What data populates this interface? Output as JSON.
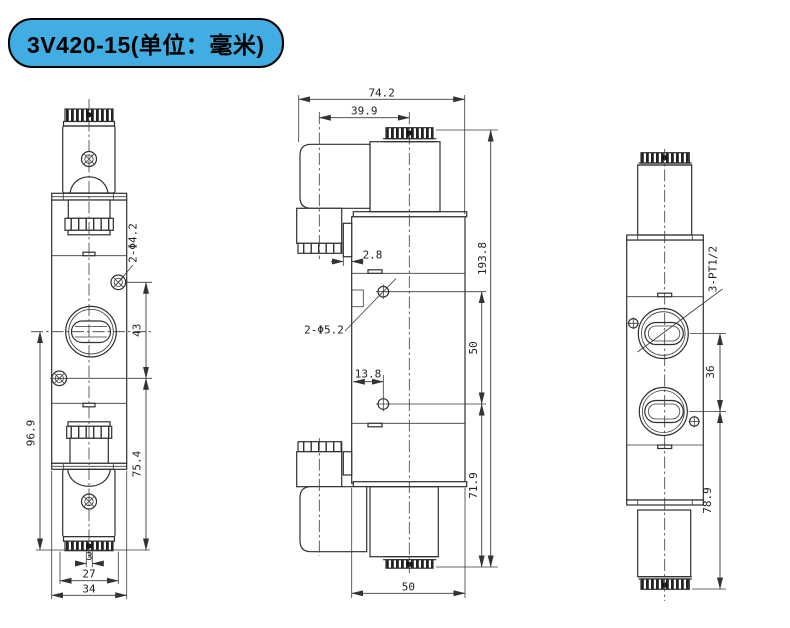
{
  "title": {
    "badge": "3V420-15(单位：毫米)",
    "badge_bg": "#41ade2",
    "badge_text_color": "#000000"
  },
  "drawing": {
    "line_color": "#2f2f2f",
    "views": {
      "front": {
        "dims": {
          "hole_callout": "2-Φ4.2",
          "hole_spacing": "43",
          "total_height": "96.9",
          "lower_height": "75.4",
          "pin_width": "3",
          "coil_width": "27",
          "body_width": "34"
        }
      },
      "side": {
        "dims": {
          "total_width": "74.2",
          "coil_offset": "39.9",
          "tab_depth": "2.8",
          "total_height": "193.8",
          "hole_callout": "2-Φ5.2",
          "hole_spacing": "50",
          "hole_offset": "13.8",
          "lower_height": "71.9",
          "body_width": "50"
        }
      },
      "end": {
        "dims": {
          "port_callout": "3-PT1/2",
          "port_spacing": "36",
          "lower_height": "78.9"
        }
      }
    }
  }
}
